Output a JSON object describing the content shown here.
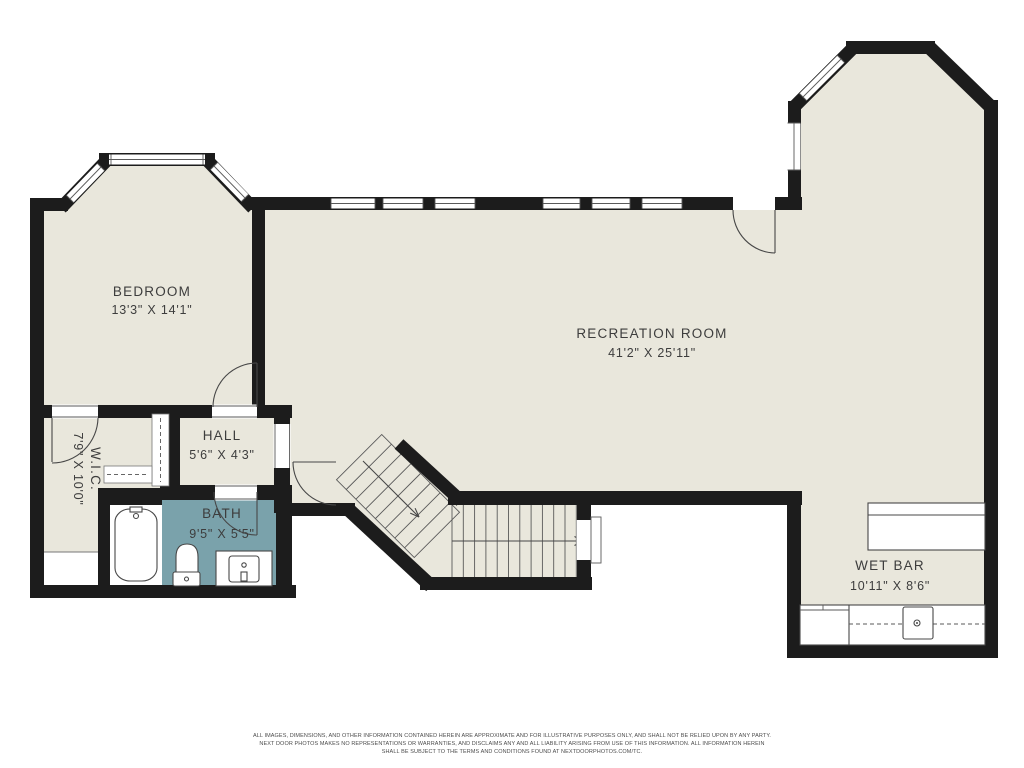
{
  "colors": {
    "floor": "#e9e7dc",
    "bath_floor": "#7aa2ab",
    "wall": "#1c1c1c",
    "fixture_line": "#474747",
    "text": "#3d3d3d",
    "background": "#ffffff"
  },
  "rooms": {
    "bedroom": {
      "name": "BEDROOM",
      "dims": "13'3\" X 14'1\""
    },
    "recreation_room": {
      "name": "RECREATION ROOM",
      "dims": "41'2\" X 25'11\""
    },
    "hall": {
      "name": "HALL",
      "dims": "5'6\" X 4'3\""
    },
    "wic": {
      "name": "W.I.C.",
      "dims": "7'9\" X 10'0\""
    },
    "bath": {
      "name": "BATH",
      "dims": "9'5\" X 5'5\""
    },
    "wet_bar": {
      "name": "WET BAR",
      "dims": "10'11\" X 8'6\""
    }
  },
  "disclaimer": {
    "line1": "ALL IMAGES, DIMENSIONS, AND OTHER INFORMATION CONTAINED HEREIN ARE APPROXIMATE AND FOR ILLUSTRATIVE PURPOSES ONLY, AND SHALL NOT BE RELIED UPON BY ANY PARTY.",
    "line2": "NEXT DOOR PHOTOS MAKES NO REPRESENTATIONS OR WARRANTIES, AND DISCLAIMS ANY AND ALL LIABILITY ARISING FROM USE OF THIS INFORMATION. ALL INFORMATION HEREIN",
    "line3": "SHALL BE SUBJECT TO THE TERMS AND CONDITIONS FOUND AT NEXTDOORPHOTOS.COM/TC."
  }
}
